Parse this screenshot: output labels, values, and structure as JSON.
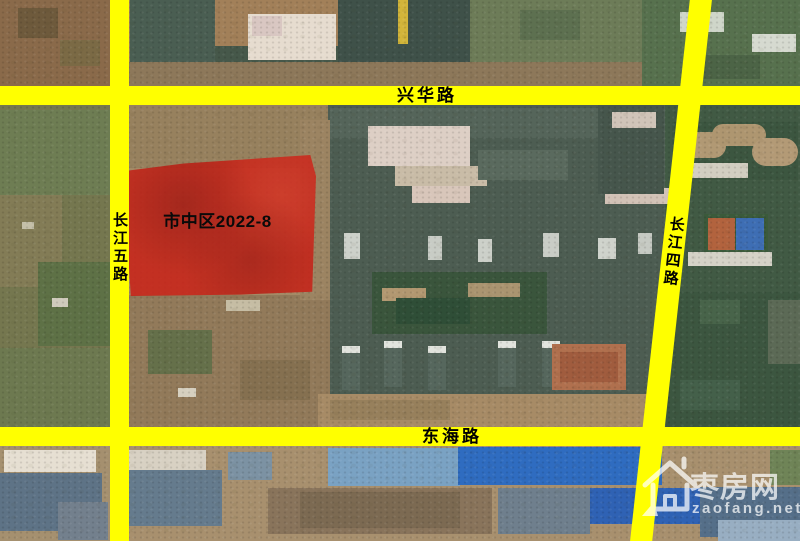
{
  "roads": {
    "xinghua": {
      "label": "兴华路"
    },
    "donghai": {
      "label": "东海路"
    },
    "changjiang5": {
      "label": "长江五路"
    },
    "changjiang4": {
      "label": "长江四路"
    }
  },
  "parcel": {
    "label": "市中区2022-8",
    "fill_color": "#ca2016"
  },
  "watermark": {
    "site_name": "枣房网",
    "site_url": "zaofang.net"
  },
  "colors": {
    "road": "#ffff00",
    "road_text": "#000000",
    "watermark_text": "#ffffff"
  }
}
